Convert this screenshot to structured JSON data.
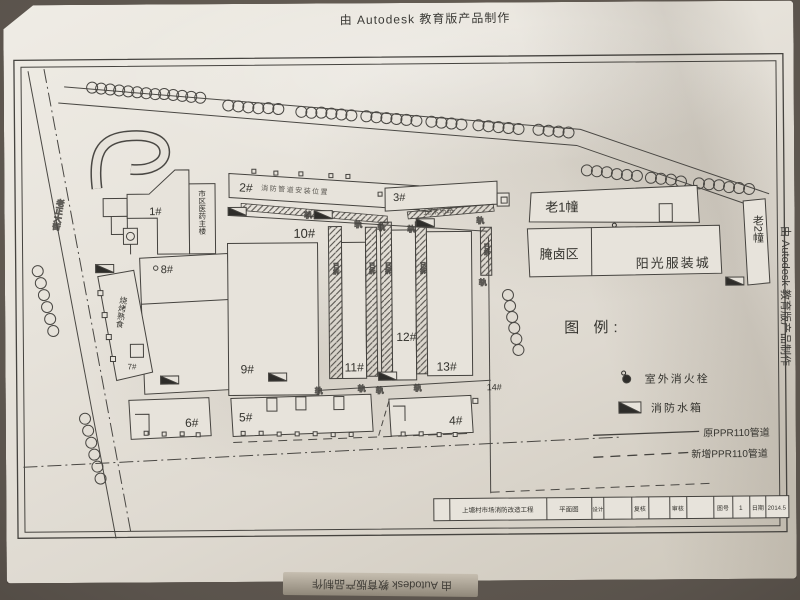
{
  "watermark": {
    "top": "由 Autodesk 教育版产品制作",
    "right": "由 Autodesk 教育版产品制作",
    "bottom": "由 Autodesk 教育版产品制作"
  },
  "buildings": {
    "b1": "1#",
    "b2": "2#",
    "b3": "3#",
    "b4": "4#",
    "b5": "5#",
    "b6": "6#",
    "b7": "7#",
    "b8": "8#",
    "b9": "9#",
    "b10": "10#",
    "b11": "11#",
    "b12": "12#",
    "b13": "13#",
    "b14": "14#",
    "old1": "老1幢",
    "old2": "老2幢",
    "brine": "腌卤区",
    "sunshine": "阳光服装城",
    "medicine": "市区医药主楼",
    "food": "烧烤熟食"
  },
  "annotations": {
    "note2": "消防管道安装位置",
    "note3": "12米马路",
    "street": "老正大街",
    "mark": "轨",
    "strip_note": "已拆"
  },
  "legend": {
    "title": "图 例:",
    "hydrant": "室外消火栓",
    "tank": "消防水箱",
    "pipe_old": "原PPR110管道",
    "pipe_new": "新增PPR110管道"
  },
  "titleblock": {
    "project": "上塘村市场消防改造工程",
    "drawing": "平面图",
    "design_label": "设计",
    "check_label": "复核",
    "review_label": "审核",
    "sheet_label": "图号",
    "sheet_no": "1",
    "date_label": "日期",
    "date": "2014.5"
  },
  "colors": {
    "ink": "#45433f",
    "paper": "#e7e3db"
  }
}
